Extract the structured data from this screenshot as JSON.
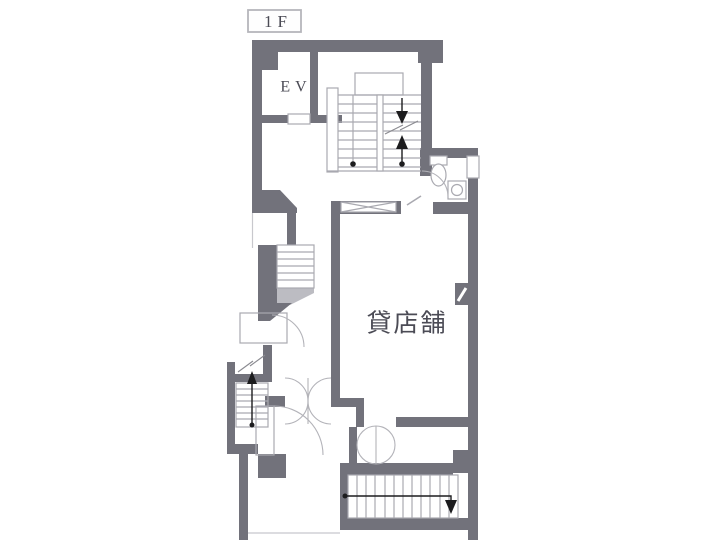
{
  "floor": {
    "label": "1F"
  },
  "rooms": {
    "elevator": {
      "label": "EV"
    },
    "shop": {
      "label": "貸店舗"
    }
  },
  "colors": {
    "wall": "#72727b",
    "outline": "#a9a9b0",
    "detail_dark": "#1c1c1e",
    "light_fill": "#bcbcc2",
    "text": "#4b4b55",
    "background": "#ffffff",
    "title_border": "#b6b6bc"
  },
  "icons": {
    "stair-down-arrow": "▼",
    "stair-up-arrow": "▲",
    "toilet": "wc-bowl-symbol",
    "sink": "corner-basin-symbol"
  }
}
